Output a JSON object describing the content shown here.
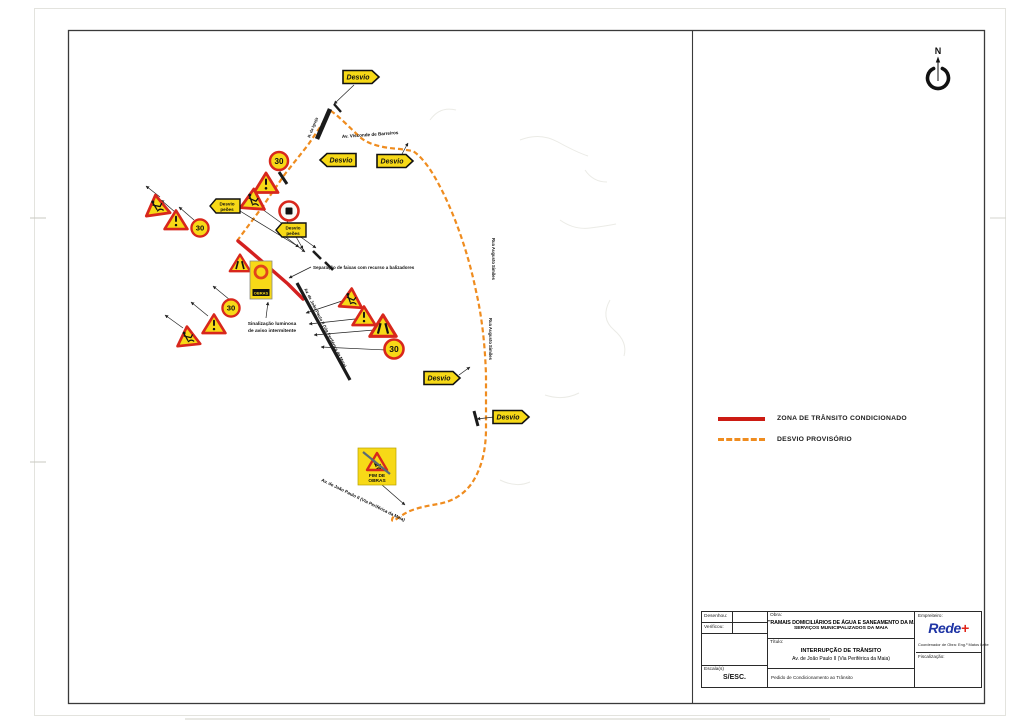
{
  "north": {
    "label": "N"
  },
  "legend": {
    "items": [
      {
        "label": "ZONA DE TRÂNSITO CONDICIONADO",
        "style": "solid",
        "color": "#cc1b13"
      },
      {
        "label": "DESVIO PROVISÓRIO",
        "style": "dashed",
        "color": "#ef8c1f"
      }
    ]
  },
  "title_block": {
    "drew_label": "Desenhou:",
    "checked_label": "Verificou:",
    "scale_label": "Escala(s)",
    "scale_value": "S/ESC.",
    "work_label": "Obra:",
    "work_line1": "\"RAMAIS DOMICILIÁRIOS DE ÁGUA E SANEAMENTO DA MAIA\"",
    "work_line2": "SERVIÇOS MUNICIPALIZADOS DA MAIA",
    "title_label": "Título:",
    "title_line1": "INTERRUPÇÃO DE TRÂNSITO",
    "title_line2": "Av. de João Paulo II (Via Periférica da Maia)",
    "subject_text": "Pedido de Condicionamento ao Trânsito",
    "contractor_label": "Empreiteiro:",
    "logo_text": "Rede",
    "logo_plus": "+",
    "coordinator_text": "Coordenador de Obra: Eng.º Matos Leite",
    "supervision_label": "Fiscalização:"
  },
  "map": {
    "colors": {
      "detour": "#ef8c1f",
      "restricted": "#d42020",
      "sign_yellow": "#f7d917",
      "sign_red": "#d8271c",
      "ink": "#1b1b1b"
    },
    "sign_text": {
      "desvio": "Desvio",
      "desvio_peoes_1": "Desvio",
      "desvio_peoes_2": "peões",
      "speed": "30",
      "signal_band": "OBRAS",
      "fim_1": "FIM DE",
      "fim_2": "OBRAS"
    },
    "detour_path": "M237 241 L263 206 L285 174 L308 145 L331 111 C340 117 352 130 361 138 C370 145 384 148 400 149 L413 151 C425 159 436 177 447 201 C458 225 469 257 476 291 C482 317 485 345 486 375 L486 428 C486 452 481 469 472 483 C463 496 450 502 438 504 C427 506 414 508 404 514 L395 520 C391 523 391 517 396 515",
    "restricted_path": "M238 241 C254 254 274 272 288 284 C295 291 299 295 303 299",
    "roads": [
      {
        "d": "M317 139 L330 109",
        "w": 4.5
      },
      {
        "d": "M297 283 L350 380",
        "w": 3.2
      },
      {
        "d": "M279 172 L287 184",
        "w": 3
      },
      {
        "d": "M334 104 L341 112",
        "w": 2.4
      },
      {
        "d": "M313 251 L321 259",
        "w": 2.6
      },
      {
        "d": "M325 262 L333 270",
        "w": 2.6
      },
      {
        "d": "M474 411 L478 426",
        "w": 3
      }
    ],
    "leaders": [
      {
        "x1": 160,
        "y1": 197,
        "x2": 146,
        "y2": 186
      },
      {
        "x1": 175,
        "y1": 212,
        "x2": 161,
        "y2": 200
      },
      {
        "x1": 194,
        "y1": 220,
        "x2": 179,
        "y2": 207
      },
      {
        "x1": 230,
        "y1": 300,
        "x2": 213,
        "y2": 286
      },
      {
        "x1": 208,
        "y1": 316,
        "x2": 191,
        "y2": 302
      },
      {
        "x1": 183,
        "y1": 328,
        "x2": 165,
        "y2": 315
      },
      {
        "x1": 262,
        "y1": 209,
        "x2": 316,
        "y2": 248
      },
      {
        "x1": 287,
        "y1": 221,
        "x2": 303,
        "y2": 249
      },
      {
        "x1": 282,
        "y1": 234,
        "x2": 305,
        "y2": 252
      },
      {
        "x1": 240,
        "y1": 211,
        "x2": 299,
        "y2": 247
      },
      {
        "x1": 311,
        "y1": 267,
        "x2": 289,
        "y2": 278
      },
      {
        "x1": 266,
        "y1": 318,
        "x2": 268,
        "y2": 302
      },
      {
        "x1": 342,
        "y1": 301,
        "x2": 306,
        "y2": 313
      },
      {
        "x1": 355,
        "y1": 319,
        "x2": 309,
        "y2": 324
      },
      {
        "x1": 374,
        "y1": 330,
        "x2": 314,
        "y2": 335
      },
      {
        "x1": 386,
        "y1": 350,
        "x2": 321,
        "y2": 347
      },
      {
        "x1": 354,
        "y1": 85,
        "x2": 334,
        "y2": 104
      },
      {
        "x1": 402,
        "y1": 154,
        "x2": 408,
        "y2": 143
      },
      {
        "x1": 459,
        "y1": 375,
        "x2": 470,
        "y2": 367
      },
      {
        "x1": 494,
        "y1": 417,
        "x2": 477,
        "y2": 419
      },
      {
        "x1": 381,
        "y1": 484,
        "x2": 405,
        "y2": 505
      }
    ],
    "labels": [
      {
        "text": "Av. Visconde de Barreiros",
        "x": 342,
        "y": 138,
        "rot": -4,
        "size": 4.6,
        "anchor": "start"
      },
      {
        "text": "R. da Igreja",
        "x": 314,
        "y": 128,
        "rot": -68,
        "size": 4.0,
        "anchor": "middle"
      },
      {
        "text": "Av. de João Paulo II (Via Periférica da Maia)",
        "x": 304,
        "y": 289,
        "rot": 63,
        "size": 4.3,
        "anchor": "start"
      },
      {
        "text": "Av. de João Paulo II (Via Periférica da Maia)",
        "x": 321,
        "y": 481,
        "rot": 26,
        "size": 4.5,
        "anchor": "start"
      },
      {
        "text": "Rua Augusto Simões",
        "x": 492,
        "y": 238,
        "rot": 90,
        "size": 4.2,
        "anchor": "start"
      },
      {
        "text": "Rua Augusto Simões",
        "x": 489,
        "y": 318,
        "rot": 90,
        "size": 4.2,
        "anchor": "start"
      },
      {
        "text": "Separação de faixas com recurso a balizadores",
        "x": 313,
        "y": 269,
        "rot": 0,
        "size": 4.5,
        "anchor": "start"
      },
      {
        "text": "Sinalização luminosa",
        "x": 272,
        "y": 325,
        "rot": 0,
        "size": 4.8,
        "anchor": "middle"
      },
      {
        "text": "de aviso intermitente",
        "x": 272,
        "y": 332,
        "rot": 0,
        "size": 4.8,
        "anchor": "middle"
      }
    ],
    "signs": [
      {
        "type": "tri-worker",
        "x": 157,
        "y": 206,
        "s": 1.0,
        "rot": -8
      },
      {
        "type": "tri-exclaim",
        "x": 176,
        "y": 221,
        "s": 0.95,
        "rot": 0
      },
      {
        "type": "circle-30",
        "x": 200,
        "y": 228,
        "s": 0.9
      },
      {
        "type": "tri-exclaim",
        "x": 266,
        "y": 184,
        "s": 1.0
      },
      {
        "type": "tri-worker",
        "x": 253,
        "y": 200,
        "s": 1.0,
        "rot": 4
      },
      {
        "type": "circle-30",
        "x": 279,
        "y": 161,
        "s": 0.95
      },
      {
        "type": "desvio-peoes",
        "x": 225,
        "y": 206
      },
      {
        "type": "desvio-peoes",
        "x": 291,
        "y": 230
      },
      {
        "type": "circle-square",
        "x": 289,
        "y": 211,
        "s": 1.0
      },
      {
        "type": "tri-narrow",
        "x": 240,
        "y": 264,
        "s": 0.85
      },
      {
        "type": "signal-rect",
        "x": 261,
        "y": 280
      },
      {
        "type": "tri-worker",
        "x": 188,
        "y": 337,
        "s": 0.95,
        "rot": -6
      },
      {
        "type": "tri-exclaim",
        "x": 214,
        "y": 325,
        "s": 0.95
      },
      {
        "type": "circle-30",
        "x": 231,
        "y": 308,
        "s": 0.9
      },
      {
        "type": "tri-worker",
        "x": 351,
        "y": 299,
        "s": 0.95,
        "rot": 4
      },
      {
        "type": "tri-exclaim",
        "x": 364,
        "y": 317,
        "s": 0.95
      },
      {
        "type": "tri-narrow",
        "x": 383,
        "y": 327,
        "s": 1.1
      },
      {
        "type": "circle-30",
        "x": 394,
        "y": 349,
        "s": 1.0
      },
      {
        "type": "desvio-right",
        "x": 361,
        "y": 77
      },
      {
        "type": "desvio-left",
        "x": 338,
        "y": 160
      },
      {
        "type": "desvio-right",
        "x": 395,
        "y": 161
      },
      {
        "type": "desvio-right",
        "x": 442,
        "y": 378
      },
      {
        "type": "desvio-right",
        "x": 511,
        "y": 417
      },
      {
        "type": "fim-obras",
        "x": 377,
        "y": 466
      }
    ],
    "faint_lines": [
      "M520 140 q20 -8 38 2 t30 14",
      "M560 220 q14 10 30 8 t26 -4",
      "M610 300 q-10 18 4 30 t10 26",
      "M545 395 q18 6 34 -2",
      "M430 120 q10 -14 26 -10",
      "M585 170 q8 12 22 12",
      "M500 480 q16 8 30 2"
    ]
  }
}
